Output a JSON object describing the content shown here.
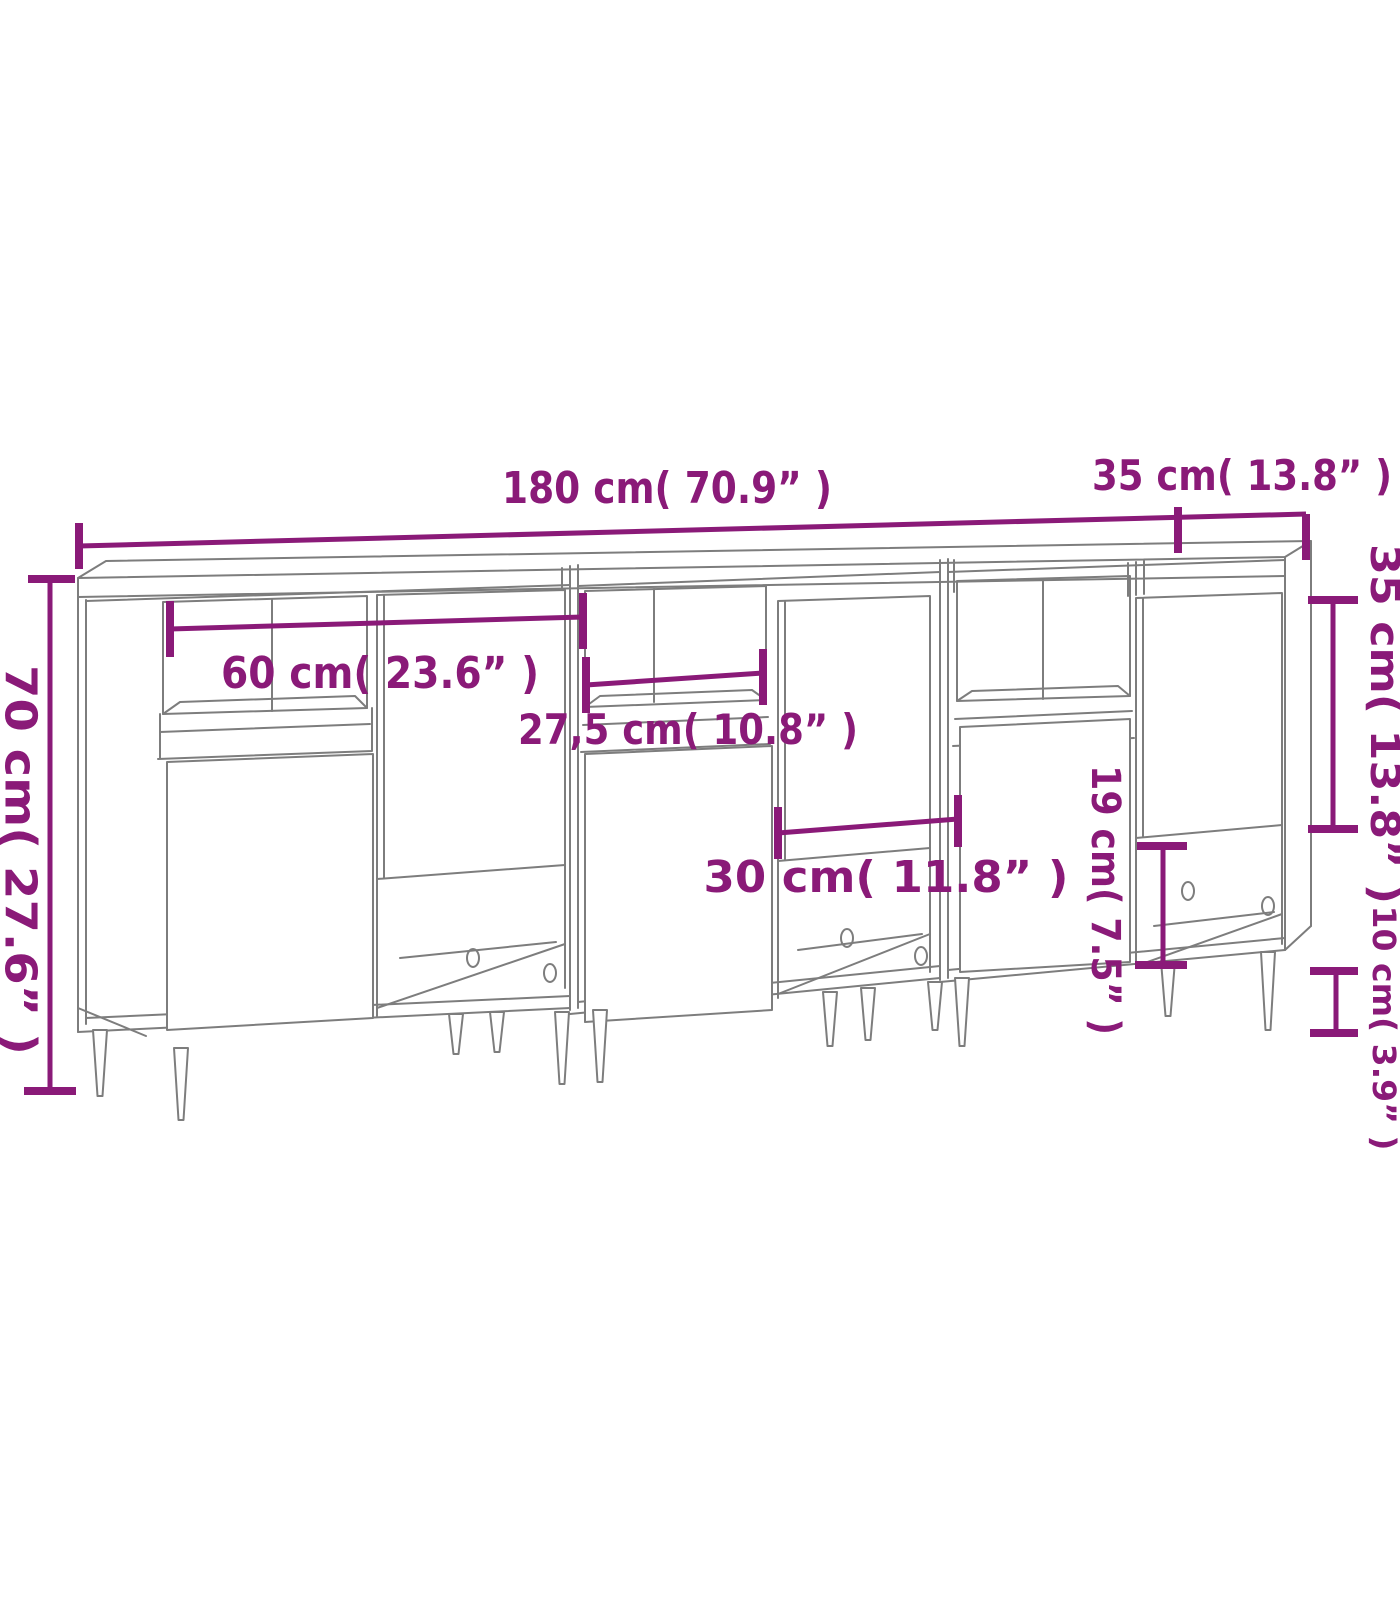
{
  "diagram": {
    "title": "Sideboard set dimension diagram (3 pieces)",
    "colors": {
      "dimension_annotation": "#8a1a78",
      "drawing_lines": "#7d7d7d",
      "background": "#ffffff"
    },
    "dimensions": {
      "total_width": "180 cm( 70.9” )",
      "top_depth": "35 cm( 13.8” )",
      "total_height": "70 cm( 27.6” )",
      "open_shelf_width": "60 cm( 23.6” )",
      "inner_shelf_width": "27,5 cm( 10.8” )",
      "door_width": "30 cm( 11.8” )",
      "open_compartment_height": "19 cm( 7.5” )",
      "side_door_height": "35 cm( 13.8” )",
      "leg_height": "10 cm( 3.9” )"
    }
  }
}
